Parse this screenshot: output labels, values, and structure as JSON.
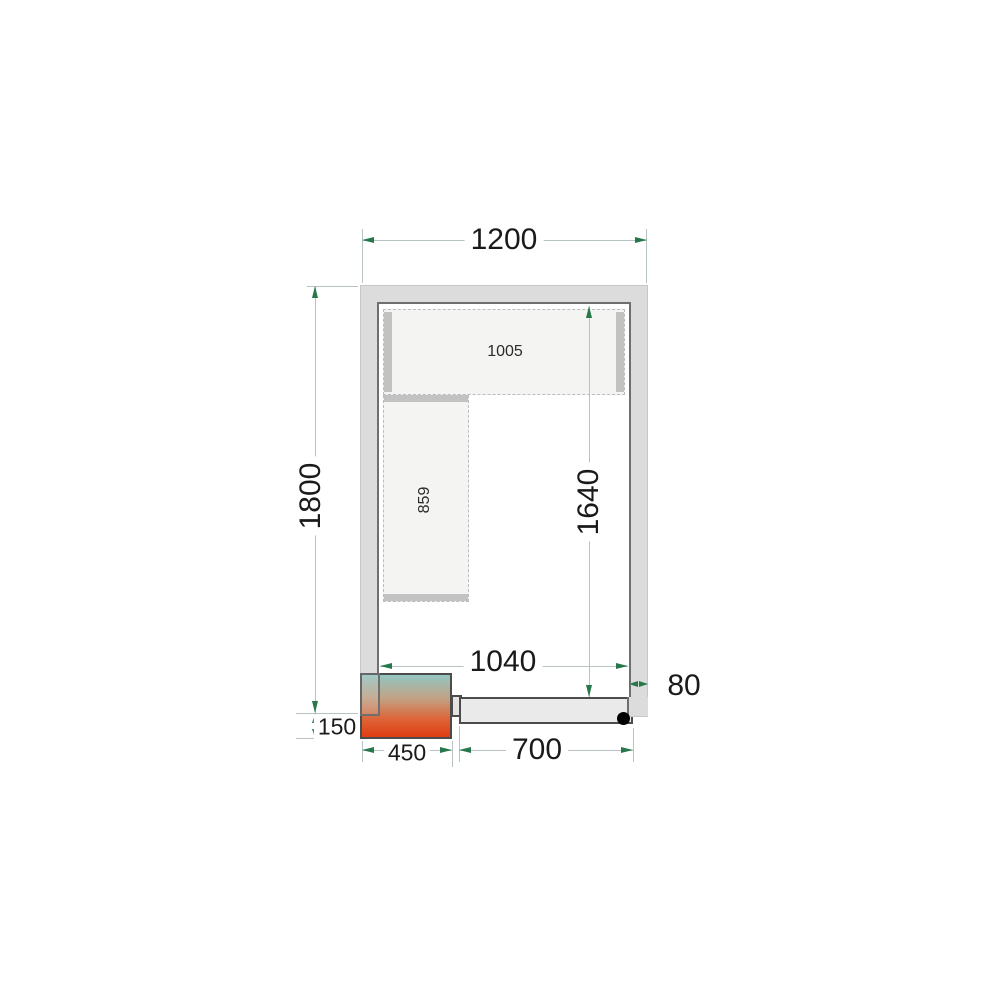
{
  "meta": {
    "drawing_type": "cold-room floor plan (top view)"
  },
  "dimensions": {
    "outer_width": "1200",
    "outer_depth": "1800",
    "inner_width": "1040",
    "inner_depth": "1640",
    "wall_thickness": "80",
    "unit_offset": "150",
    "unit_width": "450",
    "door_width": "700",
    "back_shelf_length": "1005",
    "side_shelf_length": "859"
  },
  "colors": {
    "arrow_green": "#26784a",
    "dim_line": "#b9c2c2",
    "wall_fill": "#dcdcdc",
    "wall_border": "#6f6f6f",
    "shelf_fill": "#f4f4f2",
    "shelf_bar": "#c2c2c2",
    "door_fill": "#eaeaea",
    "unit_gradient_top": "#93c6c1",
    "unit_gradient_mid": "#c2a183",
    "unit_gradient_bottom": "#e03c12",
    "door_handle": "#000000"
  }
}
